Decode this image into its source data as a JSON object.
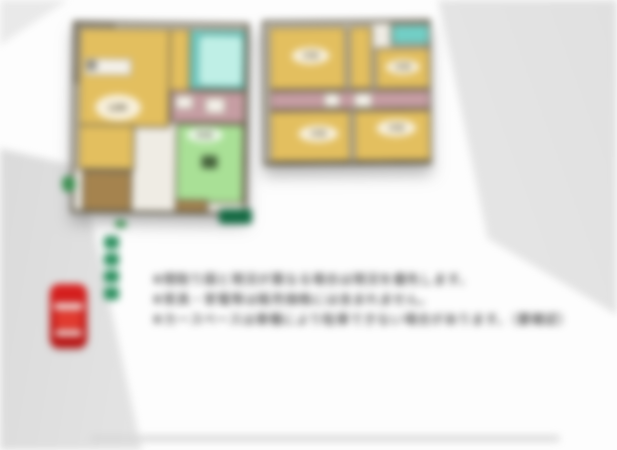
{
  "floor1": {
    "label": "1F",
    "rooms": {
      "ldk": "LDK",
      "washitsu": "和室"
    }
  },
  "floor2": {
    "label": "2F",
    "rooms": {
      "bedroom1": "洋室",
      "bedroom2": "洋室",
      "bedroom3": "洋室",
      "bedroom4": "洋室"
    }
  },
  "notes": {
    "line1": "※間取り図と現況が異なる場合は現況を優先します。",
    "line2": "※家具・家電等は販売価格には含まれません。",
    "line3": "※カースペースは車種により駐車できない場合があります。（要確認）"
  },
  "icons": {
    "car": "red-car-top-view",
    "path_markers": "green-approach-markers",
    "chip": "green-label-chip"
  },
  "colors": {
    "room_yellow": "#e3bf5f",
    "tatami_green": "#a9e096",
    "bath_teal": "#72cfc6",
    "tub_cyan": "#bfefe6",
    "hall_pink": "#c69da3",
    "porch_brown": "#a5834e",
    "marker_green": "#2e9060",
    "chip_green": "#156a43",
    "car_red": "#ce1d1b",
    "wall": "#57503e"
  }
}
